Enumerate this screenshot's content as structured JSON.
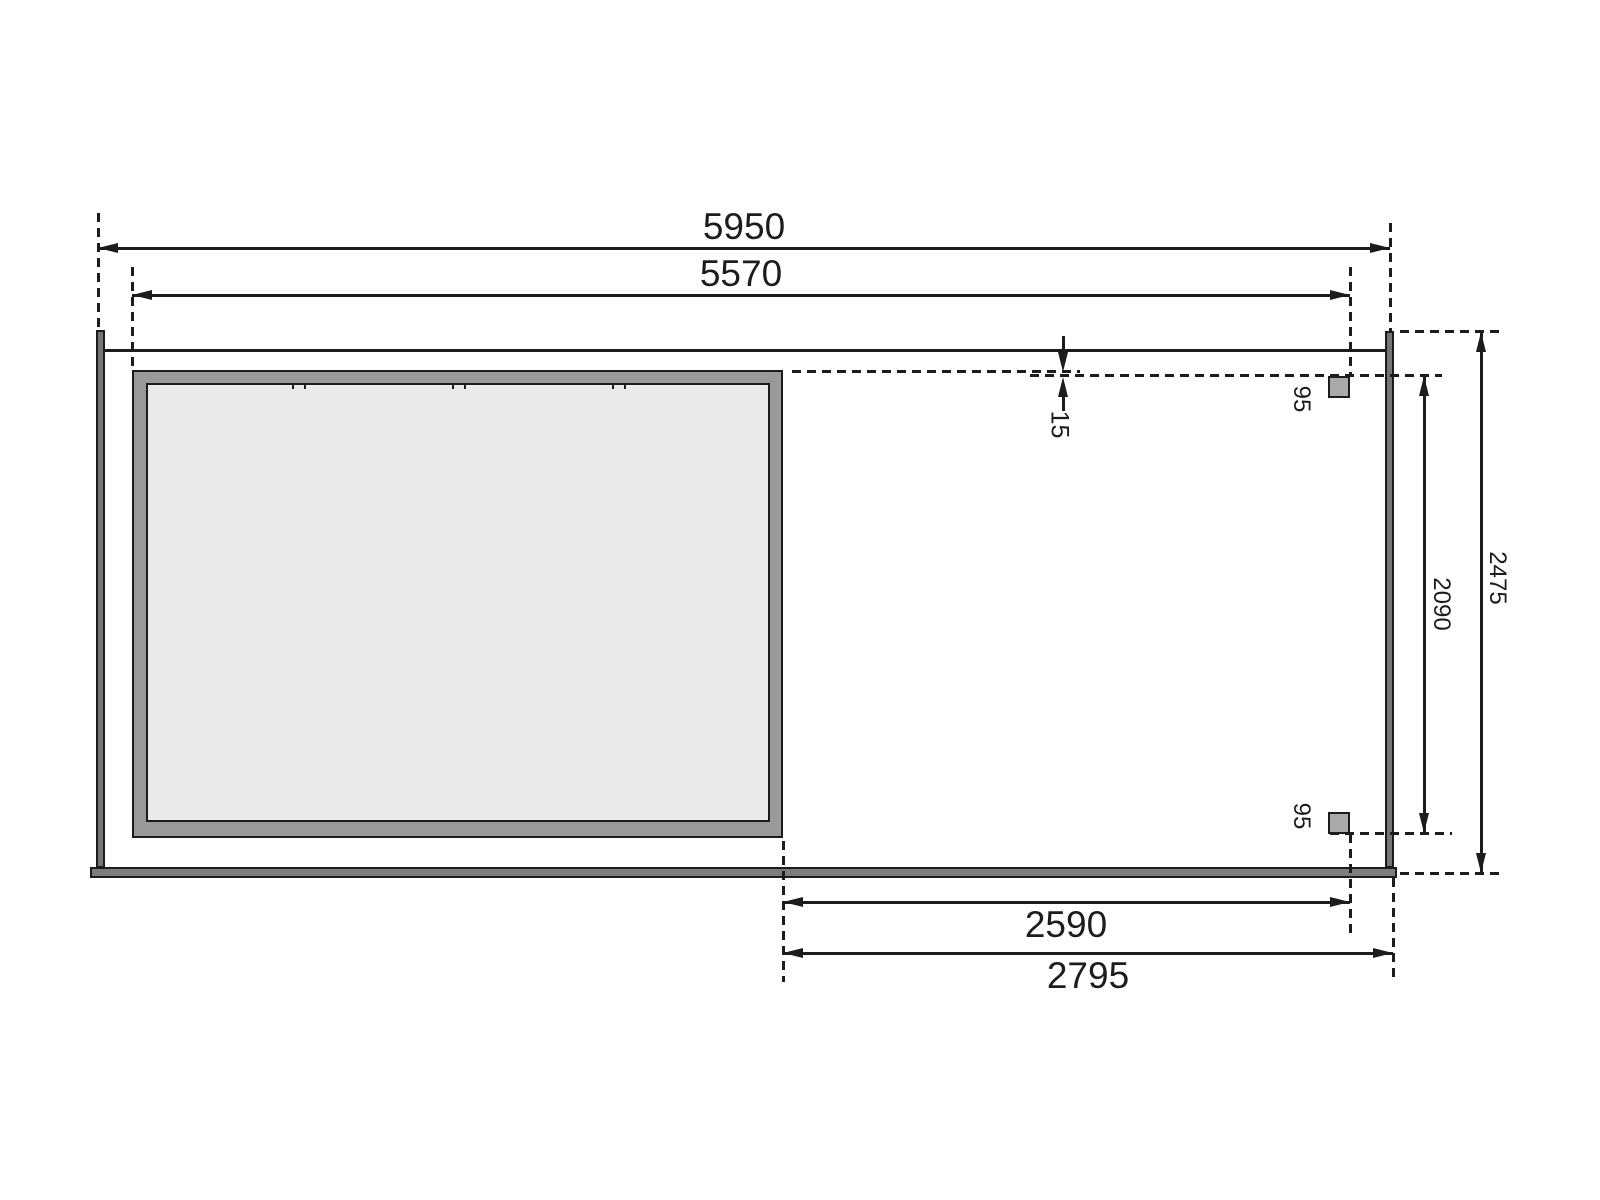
{
  "drawing": {
    "kind": "garden-house-floor-plan",
    "dimensions": {
      "overall_width": "5950",
      "inner_width": "5570",
      "annex_clear_width": "2590",
      "annex_width": "2795",
      "overall_depth": "2475",
      "post_clear_depth": "2090",
      "roof_edge_offset": "15",
      "post_size_top": "95",
      "post_size_bottom": "95"
    },
    "colors": {
      "line": "#1c1c1c",
      "wall": "#757575",
      "beam": "#7d7d7d",
      "frame": "#999999",
      "floor": "#eaeaea",
      "post": "#a9a9a9",
      "bg": "#ffffff"
    }
  }
}
